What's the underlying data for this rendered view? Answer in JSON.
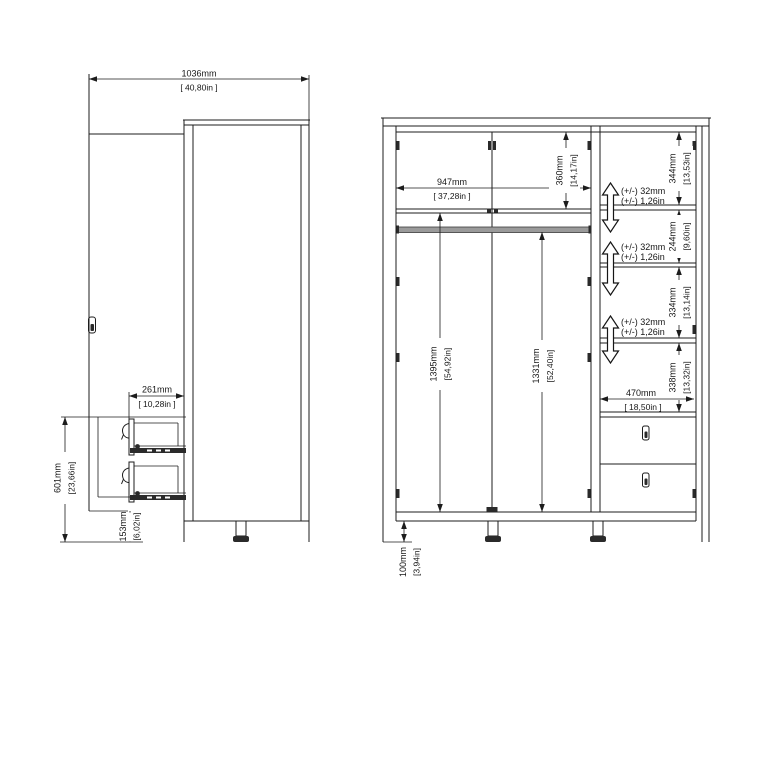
{
  "title": "wardrobe technical dimension drawing",
  "colors": {
    "background": "#ffffff",
    "line": "#1c1c1c",
    "rail_fill": "#9a9a9a",
    "foot_fill": "#2a2a2a"
  },
  "side_view": {
    "width_with_door_open": {
      "mm": "1036mm",
      "inches": "[ 40,80in ]"
    },
    "drawer_extension": {
      "mm": "261mm",
      "inches": "[ 10,28in ]"
    },
    "drawer_section_height": {
      "mm": "601mm",
      "inches": "[23,66in]"
    },
    "bottom_clearance": {
      "mm": "153mm",
      "inches": "[6,02in]"
    }
  },
  "front_view": {
    "interior_width_left": {
      "mm": "947mm",
      "inches": "[ 37,28in ]"
    },
    "top_compartment_height": {
      "mm": "360mm",
      "inches": "[14,17in]"
    },
    "right_compartment_1": {
      "mm": "344mm",
      "inches": "[13,53in]"
    },
    "right_compartment_2": {
      "mm": "244mm",
      "inches": "[9,60in]"
    },
    "right_compartment_3": {
      "mm": "334mm",
      "inches": "[13,14in]"
    },
    "right_compartment_4": {
      "mm": "338mm",
      "inches": "[13,32in]"
    },
    "interior_width_right": {
      "mm": "470mm",
      "inches": "[ 18,50in ]"
    },
    "left_clearance_height": {
      "mm": "1395mm",
      "inches": "[54,92in]"
    },
    "rail_clearance_height": {
      "mm": "1331mm",
      "inches": "[52,40in]"
    },
    "leg_height": {
      "mm": "100mm",
      "inches": "[3,94in]"
    },
    "shelf_adjustability": {
      "mm": "(+/-) 32mm",
      "inches": "(+/-) 1,26in"
    }
  }
}
